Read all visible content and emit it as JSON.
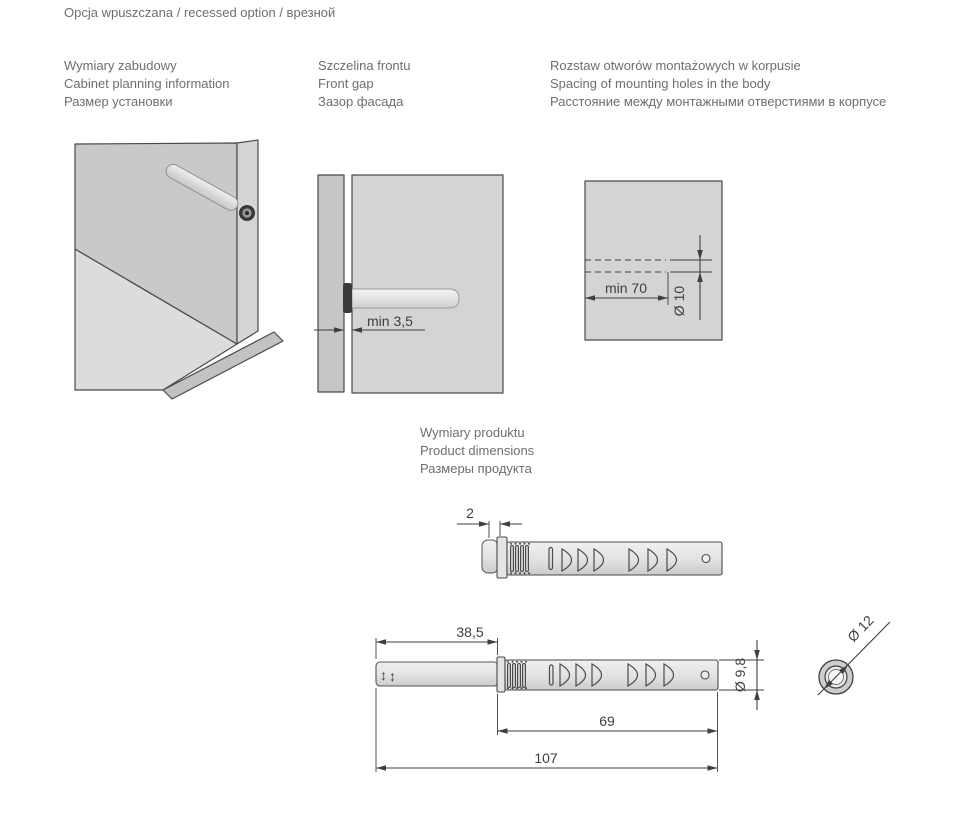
{
  "title": "Opcja wpuszczana / recessed option / врезной",
  "sections": {
    "cabinet": {
      "l1": "Wymiary zabudowy",
      "l2": "Cabinet planning information",
      "l3": "Размер установки"
    },
    "front_gap": {
      "l1": "Szczelina frontu",
      "l2": "Front gap",
      "l3": "Зазор фасада"
    },
    "mounting_holes": {
      "l1": "Rozstaw otworów montażowych w korpusie",
      "l2": "Spacing of mounting holes in the body",
      "l3": "Расстояние между монтажными отверстиями в корпусе"
    },
    "product": {
      "l1": "Wymiary produktu",
      "l2": "Product dimensions",
      "l3": "Размеры продукта"
    }
  },
  "dims": {
    "front_gap_min": "min 3,5",
    "hole_depth_min": "min 70",
    "hole_diameter": "Ø 10",
    "flange_thickness": "2",
    "pin_extension": "38,5",
    "body_length": "69",
    "total_length": "107",
    "body_diameter": "Ø 9,8",
    "head_diameter": "Ø 12",
    "adjust_icon": "↕"
  },
  "colors": {
    "label_text": "#6e6e6e",
    "dim_lines": "#3f3f3f",
    "panel_fill": "#c9c9c9",
    "panel_light": "#dcdcdc"
  }
}
